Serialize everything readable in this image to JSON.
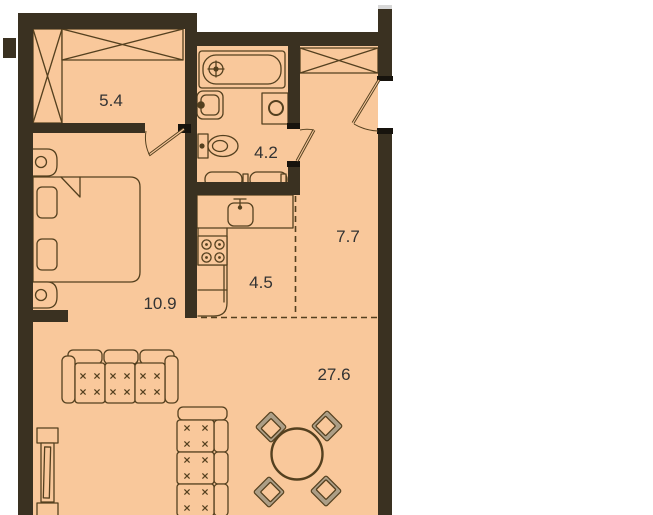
{
  "plan": {
    "type": "apartment-floor-plan",
    "rooms": [
      {
        "id": "closet",
        "area_label": "5.4"
      },
      {
        "id": "bathroom",
        "area_label": "4.2"
      },
      {
        "id": "hallway",
        "area_label": "7.7"
      },
      {
        "id": "kitchen",
        "area_label": "4.5"
      },
      {
        "id": "bedroom",
        "area_label": "10.9"
      },
      {
        "id": "living_room",
        "area_label": "27.6"
      }
    ],
    "furniture_icons": [
      "wardrobe-icon",
      "bed-icon",
      "nightstand-icon",
      "bathtub-icon",
      "bathroom-sink-icon",
      "washing-machine-icon",
      "toilet-icon",
      "bathroom-cabinet-icon",
      "kitchen-counter-icon",
      "kitchen-sink-icon",
      "stove-icon",
      "sofa-icon",
      "tv-stand-icon",
      "dining-table-icon",
      "dining-chair-icon",
      "door-icon"
    ],
    "palette": {
      "floor": "#F9C89B",
      "wall": "#3A3121",
      "line": "#54401F",
      "jamb": "#17130D",
      "chairgray": "#AC9E86",
      "textcolor": "#333333",
      "outside": "#FFFFFF",
      "faded": "#D8D8D8"
    }
  }
}
